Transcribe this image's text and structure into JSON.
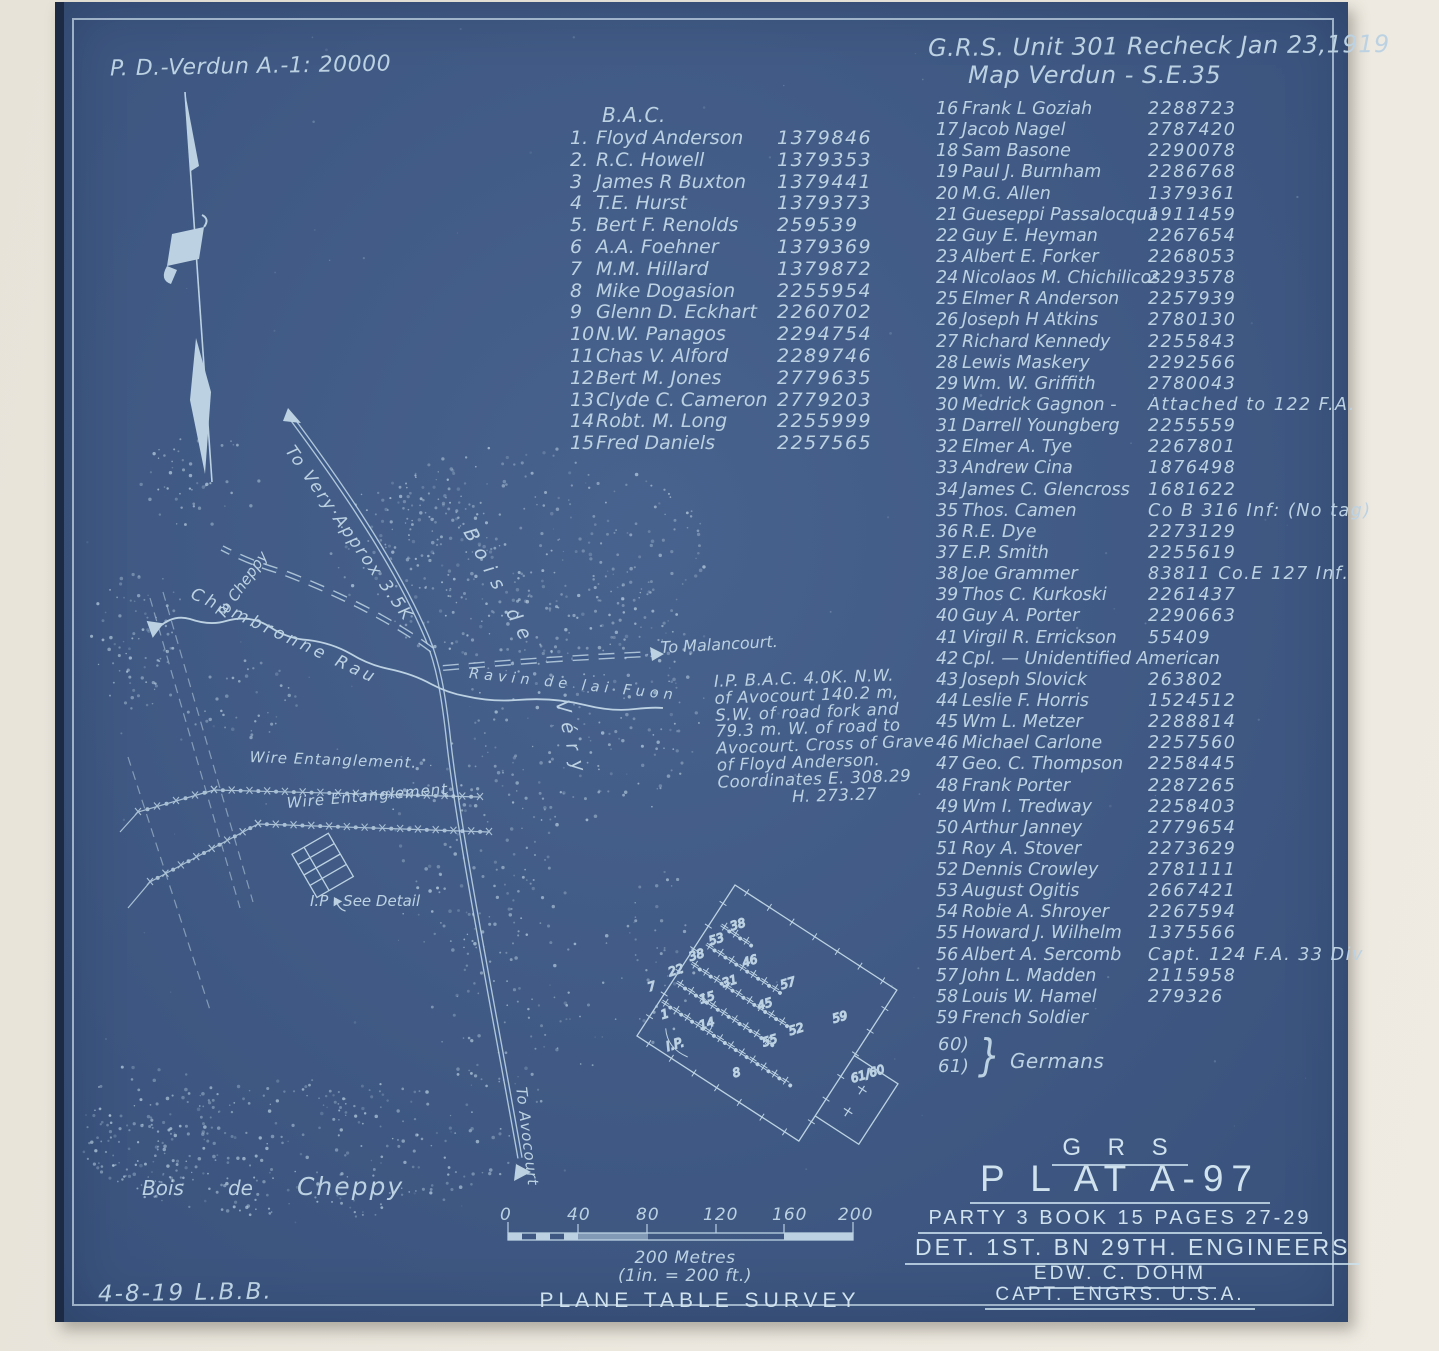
{
  "header": {
    "left_note": "P. D.-Verdun A.-1: 20000",
    "right_line1": "G.R.S. Unit 301  Recheck Jan 23,1919",
    "right_line2": "Map Verdun - S.E.35"
  },
  "bac": {
    "title": "B.A.C.",
    "entries": [
      {
        "num": "1.",
        "name": "Floyd Anderson",
        "serial": "1379846"
      },
      {
        "num": "2.",
        "name": "R.C. Howell",
        "serial": "1379353"
      },
      {
        "num": "3",
        "name": "James R Buxton",
        "serial": "1379441"
      },
      {
        "num": "4",
        "name": "T.E. Hurst",
        "serial": "1379373"
      },
      {
        "num": "5.",
        "name": "Bert F. Renolds",
        "serial": "259539"
      },
      {
        "num": "6",
        "name": "A.A. Foehner",
        "serial": "1379369"
      },
      {
        "num": "7",
        "name": "M.M. Hillard",
        "serial": "1379872"
      },
      {
        "num": "8",
        "name": "Mike Dogasion",
        "serial": "2255954"
      },
      {
        "num": "9",
        "name": "Glenn D. Eckhart",
        "serial": "2260702"
      },
      {
        "num": "10",
        "name": "N.W. Panagos",
        "serial": "2294754"
      },
      {
        "num": "11",
        "name": "Chas V. Alford",
        "serial": "2289746"
      },
      {
        "num": "12",
        "name": "Bert M. Jones",
        "serial": "2779635"
      },
      {
        "num": "13",
        "name": "Clyde C. Cameron",
        "serial": "2779203"
      },
      {
        "num": "14",
        "name": "Robt. M. Long",
        "serial": "2255999"
      },
      {
        "num": "15",
        "name": "Fred Daniels",
        "serial": "2257565"
      }
    ]
  },
  "roster": {
    "entries": [
      {
        "num": "16",
        "name": "Frank L Goziah",
        "serial": "2288723"
      },
      {
        "num": "17",
        "name": "Jacob Nagel",
        "serial": "2787420"
      },
      {
        "num": "18",
        "name": "Sam Basone",
        "serial": "2290078"
      },
      {
        "num": "19",
        "name": "Paul J. Burnham",
        "serial": "2286768"
      },
      {
        "num": "20",
        "name": "M.G. Allen",
        "serial": "1379361"
      },
      {
        "num": "21",
        "name": "Gueseppi Passalocqua",
        "serial": "1911459"
      },
      {
        "num": "22",
        "name": "Guy E. Heyman",
        "serial": "2267654"
      },
      {
        "num": "23",
        "name": "Albert E. Forker",
        "serial": "2268053"
      },
      {
        "num": "24",
        "name": "Nicolaos M. Chichilicos",
        "serial": "2293578"
      },
      {
        "num": "25",
        "name": "Elmer R Anderson",
        "serial": "2257939"
      },
      {
        "num": "26",
        "name": "Joseph H Atkins",
        "serial": "2780130"
      },
      {
        "num": "27",
        "name": "Richard Kennedy",
        "serial": "2255843"
      },
      {
        "num": "28",
        "name": "Lewis Maskery",
        "serial": "2292566"
      },
      {
        "num": "29",
        "name": "Wm. W. Griffith",
        "serial": "2780043"
      },
      {
        "num": "30",
        "name": "Medrick Gagnon -",
        "serial": "Attached to 122 F.A."
      },
      {
        "num": "31",
        "name": "Darrell Youngberg",
        "serial": "2255559"
      },
      {
        "num": "32",
        "name": "Elmer A. Tye",
        "serial": "2267801"
      },
      {
        "num": "33",
        "name": "Andrew Cina",
        "serial": "1876498"
      },
      {
        "num": "34",
        "name": "James C. Glencross",
        "serial": "1681622"
      },
      {
        "num": "35",
        "name": "Thos. Camen",
        "serial": "Co B 316 Inf: (No tag)"
      },
      {
        "num": "36",
        "name": "R.E. Dye",
        "serial": "2273129"
      },
      {
        "num": "37",
        "name": "E.P. Smith",
        "serial": "2255619"
      },
      {
        "num": "38",
        "name": "Joe Grammer",
        "serial": "83811  Co.E 127 Inf."
      },
      {
        "num": "39",
        "name": "Thos C. Kurkoski",
        "serial": "2261437"
      },
      {
        "num": "40",
        "name": "Guy A. Porter",
        "serial": "2290663"
      },
      {
        "num": "41",
        "name": "Virgil R. Errickson",
        "serial": "55409"
      },
      {
        "num": "42",
        "name": "Cpl. —  Unidentified American",
        "serial": ""
      },
      {
        "num": "43",
        "name": "Joseph Slovick",
        "serial": "263802"
      },
      {
        "num": "44",
        "name": "Leslie F. Horris",
        "serial": "1524512"
      },
      {
        "num": "45",
        "name": "Wm L. Metzer",
        "serial": "2288814"
      },
      {
        "num": "46",
        "name": "Michael Carlone",
        "serial": "2257560"
      },
      {
        "num": "47",
        "name": "Geo. C. Thompson",
        "serial": "2258445"
      },
      {
        "num": "48",
        "name": "Frank Porter",
        "serial": "2287265"
      },
      {
        "num": "49",
        "name": "Wm I. Tredway",
        "serial": "2258403"
      },
      {
        "num": "50",
        "name": "Arthur Janney",
        "serial": "2779654"
      },
      {
        "num": "51",
        "name": "Roy A. Stover",
        "serial": "2273629"
      },
      {
        "num": "52",
        "name": "Dennis Crowley",
        "serial": "2781111"
      },
      {
        "num": "53",
        "name": "August Ogitis",
        "serial": "2667421"
      },
      {
        "num": "54",
        "name": "Robie A. Shroyer",
        "serial": "2267594"
      },
      {
        "num": "55",
        "name": "Howard J. Wilhelm",
        "serial": "1375566"
      },
      {
        "num": "56",
        "name": "Albert A. Sercomb",
        "serial": "Capt. 124 F.A. 33 Div"
      },
      {
        "num": "57",
        "name": "John L. Madden",
        "serial": "2115958"
      },
      {
        "num": "58",
        "name": "Louis W. Hamel",
        "serial": "279326"
      },
      {
        "num": "59",
        "name": "French Soldier",
        "serial": ""
      }
    ],
    "germans": {
      "nums": [
        "60)",
        "61)"
      ],
      "brace": "}",
      "label": "Germans"
    }
  },
  "ip_note": {
    "line1": "I.P. B.A.C.  4.0K.  N.W.",
    "line2": "of Avocourt  140.2 m,",
    "line3": "S.W. of road fork and",
    "line4": "79.3 m. W. of road to",
    "line5": "Avocourt. Cross of Grave",
    "line6": "of Floyd Anderson.",
    "line7": "Coordinates E. 308.29",
    "line8": "H. 273.27"
  },
  "map_labels": {
    "to_very": "To Very·Approx 3.5K",
    "bois_de": "Bois de",
    "very": "Véry",
    "to_cheppy": "To Cheppy",
    "chambronne": "Chambronne Rau",
    "to_malancourt": "To Malancourt.",
    "ravin": "Ravin de lai Fuon",
    "wire1": "Wire Entanglement.",
    "wire2": "Wire Entanglement",
    "ip_detail": "I.P - See Detail",
    "to_avocourt": "To Avocourt",
    "bois_w1": "Bois",
    "bois_w2": "de",
    "bois_w3": "Cheppy"
  },
  "plot": {
    "numbers": [
      "38",
      "53",
      "38",
      "22",
      "7",
      "46",
      "57",
      "59",
      "31",
      "45",
      "52",
      "55",
      "15",
      "14",
      "61/60",
      "8",
      "1",
      "I.P."
    ]
  },
  "scale": {
    "ticks": [
      "0",
      "40",
      "80",
      "120",
      "160",
      "200"
    ],
    "caption1": "200 Metres",
    "caption2": "(1in. = 200 ft.)",
    "caption3": "PLANE TABLE SURVEY"
  },
  "title_block": {
    "line1": "G R S",
    "line2": "P L AT  A-97",
    "line3": "PARTY 3  BOOK 15  PAGES 27-29",
    "line4": "DET.  1ST.  BN  29TH.  ENGINEERS",
    "line5": "EDW. C. DOHM",
    "line6": "CAPT.  ENGRS. U.S.A."
  },
  "footer": {
    "date_note": "4-8-19  L.B.B."
  },
  "colors": {
    "sheet": "#3e5a88",
    "ink": "#bcd2e2",
    "paper": "#e9e5db"
  }
}
